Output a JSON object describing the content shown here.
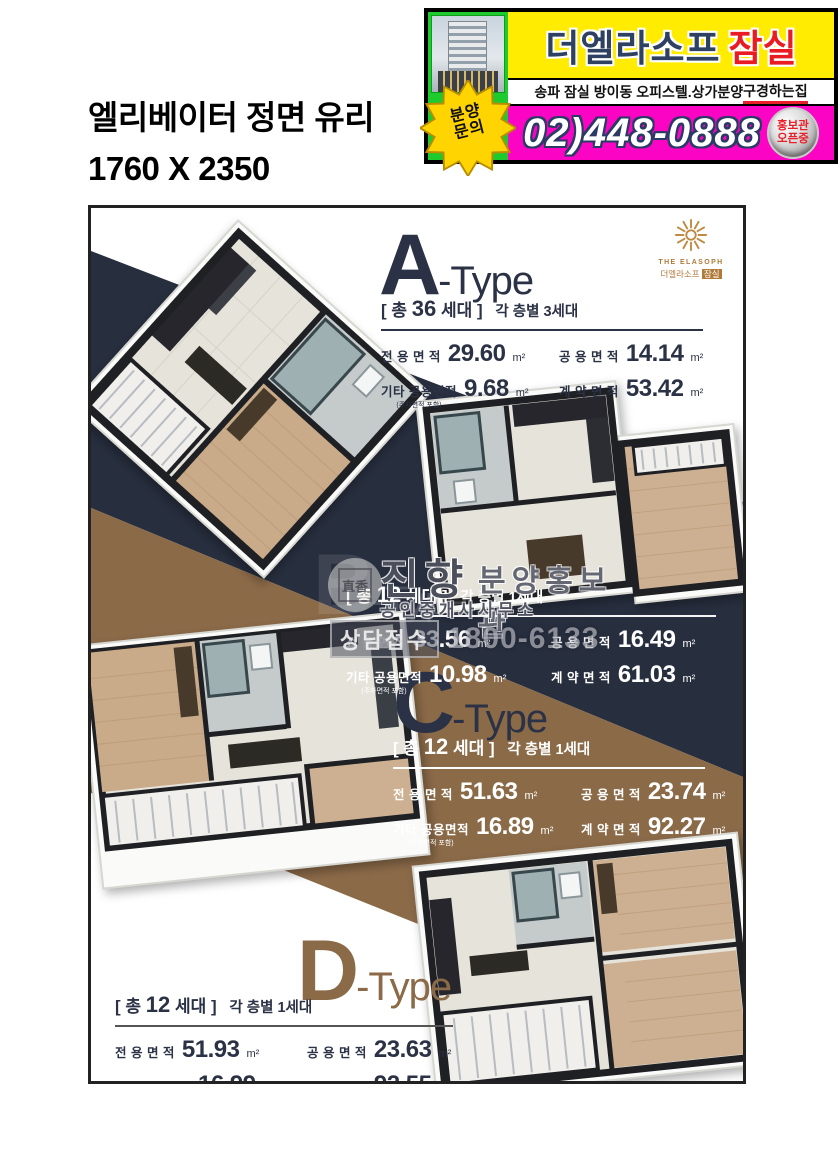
{
  "colors": {
    "navy": "#272e3e",
    "brown": "#8b6a48",
    "banner_yellow": "#ffec00",
    "banner_magenta": "#fb04c4",
    "banner_green": "#1ecb2e",
    "accent_red": "#e8202a",
    "type_ink": "#2b3245"
  },
  "header": {
    "size_label_line1": "엘리베이터 정면 유리",
    "size_label_line2": "1760 X 2350"
  },
  "banner": {
    "brand": "더엘라소프",
    "brand_location": "잠실",
    "subtitle": "송파 잠실 방이동 오피스텔.상가분양 ",
    "subtitle_highlight": "구경하는집",
    "burst_line1": "분양",
    "burst_line2": "문의",
    "phone": "02)448-0888",
    "badge_line1": "홍보관",
    "badge_line2": "오픈중"
  },
  "logo": {
    "name_en": "THE ELASOPH",
    "name_kr": "더엘라소프",
    "name_kr_tag": "잠실"
  },
  "watermark": {
    "seal_text": "直香",
    "agency": "진향",
    "agency_type": "공인중개사사무소",
    "tag": "분양홍보관",
    "contact_label": "상담접수",
    "contact_phone": "1800-6133"
  },
  "types": [
    {
      "letter": "A",
      "suffix": "-Type",
      "total_prefix": "[ 총",
      "total_count": "36",
      "total_suffix": "세대 ]",
      "per_floor": "각 층별 3세대",
      "areas": [
        {
          "label": "전 용 면 적",
          "value": "29.60",
          "unit": "m²"
        },
        {
          "label": "공 용 면 적",
          "value": "14.14",
          "unit": "m²"
        },
        {
          "label": "기타 공용면적",
          "note": "(주차면적 포함)",
          "value": "9.68",
          "unit": "m²"
        },
        {
          "label": "계 약 면 적",
          "value": "53.42",
          "unit": "m²"
        }
      ]
    },
    {
      "letter": "B",
      "suffix": "-Type",
      "total_prefix": "[ 총",
      "total_count": "12",
      "total_suffix": "세대 ]",
      "per_floor": "각 층별 1세대",
      "areas": [
        {
          "label": "전 용 면 적",
          "value": "33.56",
          "unit": "m²"
        },
        {
          "label": "공 용 면 적",
          "value": "16.49",
          "unit": "m²"
        },
        {
          "label": "기타 공용면적",
          "note": "(주차면적 포함)",
          "value": "10.98",
          "unit": "m²"
        },
        {
          "label": "계 약 면 적",
          "value": "61.03",
          "unit": "m²"
        }
      ]
    },
    {
      "letter": "C",
      "suffix": "-Type",
      "total_prefix": "[ 총",
      "total_count": "12",
      "total_suffix": "세대 ]",
      "per_floor": "각 층별 1세대",
      "areas": [
        {
          "label": "전 용 면 적",
          "value": "51.63",
          "unit": "m²"
        },
        {
          "label": "공 용 면 적",
          "value": "23.74",
          "unit": "m²"
        },
        {
          "label": "기타 공용면적",
          "note": "(주차면적 포함)",
          "value": "16.89",
          "unit": "m²"
        },
        {
          "label": "계 약 면 적",
          "value": "92.27",
          "unit": "m²"
        }
      ]
    },
    {
      "letter": "D",
      "suffix": "-Type",
      "total_prefix": "[ 총",
      "total_count": "12",
      "total_suffix": "세대 ]",
      "per_floor": "각 층별 1세대",
      "areas": [
        {
          "label": "전 용 면 적",
          "value": "51.93",
          "unit": "m²"
        },
        {
          "label": "공 용 면 적",
          "value": "23.63",
          "unit": "m²"
        },
        {
          "label": "기타 공용면적",
          "note": "(주차면적 포함)",
          "value": "16.99",
          "unit": "m²"
        },
        {
          "label": "계 약 면 적",
          "value": "92.55",
          "unit": "m²"
        }
      ]
    }
  ]
}
